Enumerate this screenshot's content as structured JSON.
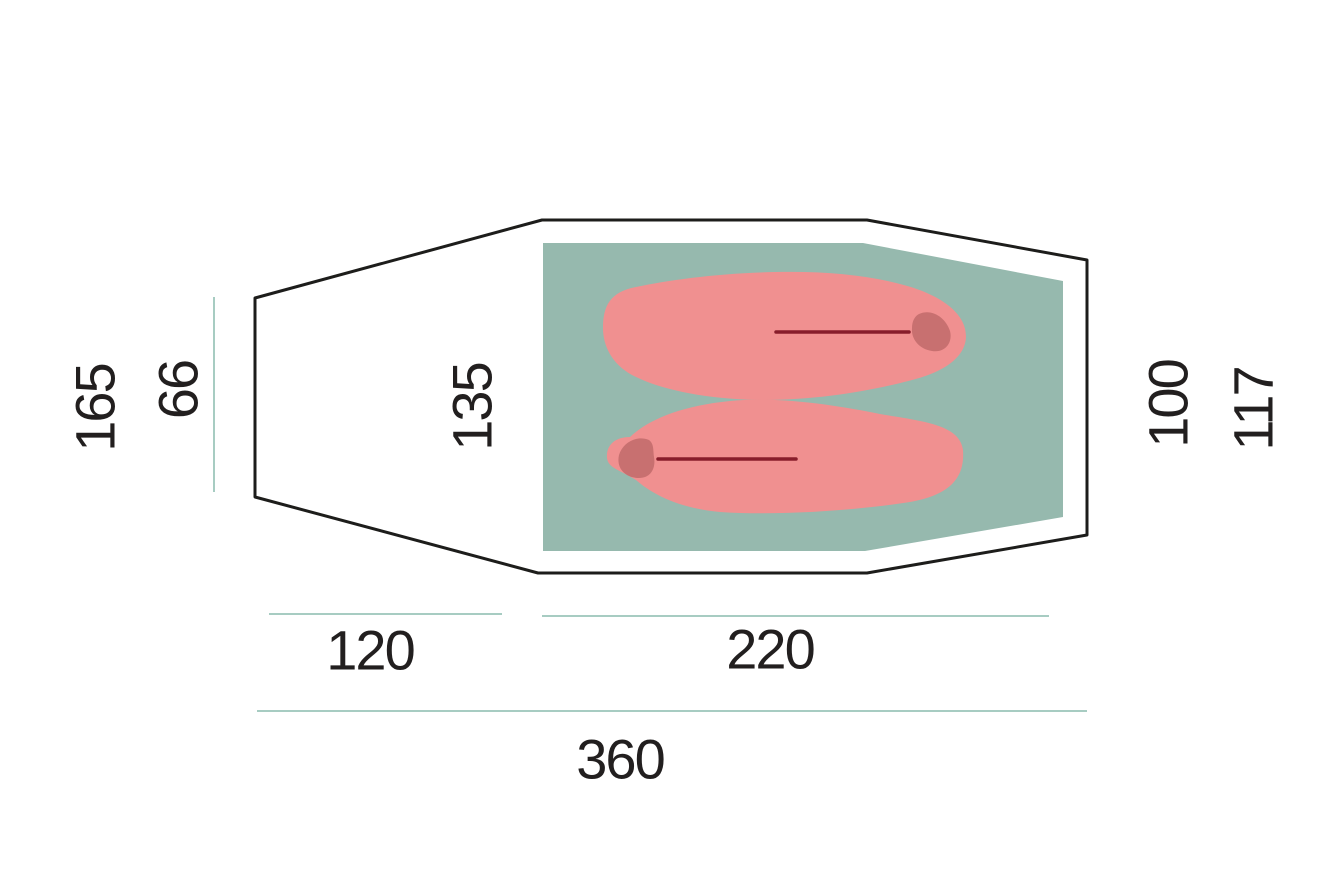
{
  "diagram": {
    "type": "tent-floor-plan",
    "dimensions": {
      "left_outer": "165",
      "left_inner": "66",
      "middle_inner_width": "135",
      "right_inner": "100",
      "right_outer": "117",
      "bottom_vestibule_length": "120",
      "bottom_inner_length": "220",
      "bottom_total_length": "360"
    }
  },
  "colors": {
    "background": "#ffffff",
    "outline": "#1d1d1b",
    "inner_tent_floor": "#96b9ae",
    "sleeping_bag": "#f09090",
    "sleeping_bag_hood": "#c87070",
    "zipper": "#871d2b",
    "dimension_line": "#a7ccc2",
    "text": "#221f1f"
  }
}
